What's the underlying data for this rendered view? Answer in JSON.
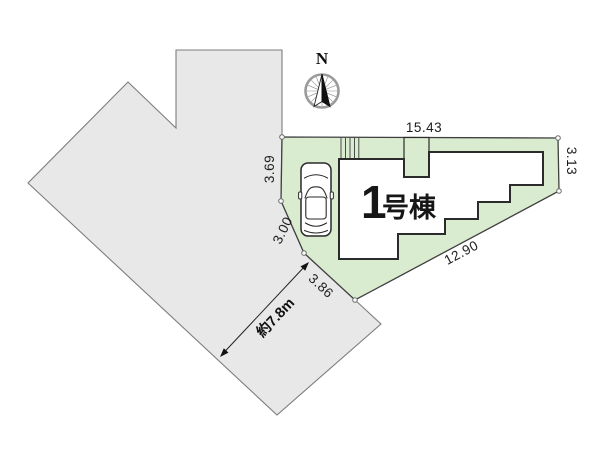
{
  "site_plan": {
    "north_label": "N",
    "building": {
      "number": "1",
      "suffix": "号棟"
    },
    "dimensions": {
      "top_edge": "15.43",
      "left_upper_edge": "3.69",
      "left_middle_edge": "3.00",
      "left_lower_edge": "3.86",
      "bottom_right_edge": "12.90",
      "right_edge": "3.13",
      "road_width": "約7.8m"
    },
    "colors": {
      "lot_fill": "#daecd0",
      "road_fill": "#e8e8e9",
      "lot_outline": "#3f3f3f",
      "building_outline": "#2b2b2b",
      "road_outline": "#7d7d7d"
    }
  }
}
